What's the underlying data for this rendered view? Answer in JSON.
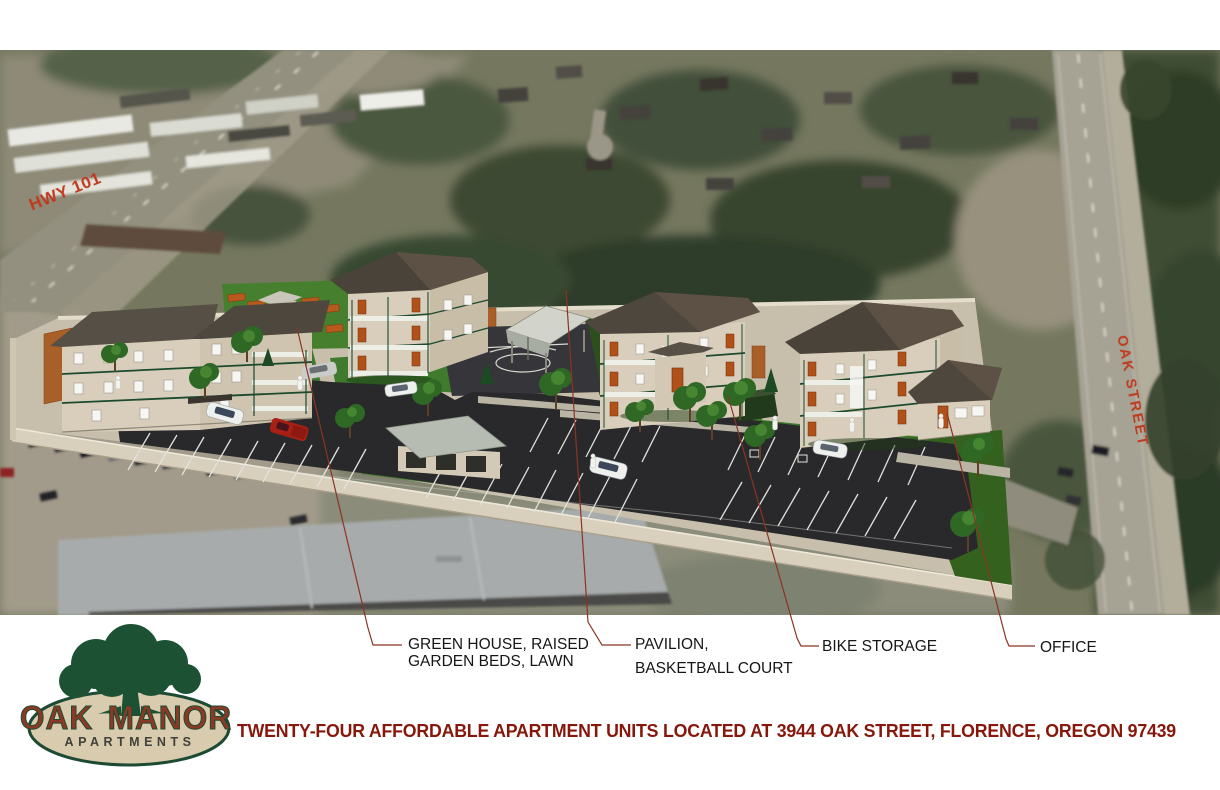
{
  "map_labels": {
    "hwy101": "HWY 101",
    "oak_street": "OAK STREET"
  },
  "callouts": [
    {
      "line1": "GREEN HOUSE, RAISED",
      "line2": "GARDEN BEDS, LAWN",
      "points_to": "greenhouse-and-garden-area"
    },
    {
      "line1": "PAVILION,",
      "line2": "BASKETBALL COURT",
      "points_to": "pavilion"
    },
    {
      "line1": "BIKE STORAGE",
      "points_to": "bike-storage-shed"
    },
    {
      "line1": "OFFICE",
      "points_to": "office-building"
    }
  ],
  "logo": {
    "word1": "OAK",
    "word2": "MANOR",
    "subtitle": "APARTMENTS"
  },
  "tagline": "TWENTY-FOUR AFFORDABLE APARTMENT UNITS LOCATED AT 3944 OAK STREET, FLORENCE, OREGON 97439",
  "colors": {
    "road_label_red": "#bf3a1e",
    "tagline_maroon": "#87170b",
    "leader_line": "#8b3424",
    "logo_green": "#1d4a33",
    "logo_tan": "#d9cbae",
    "logo_maroon": "#8a3a24",
    "lawn_green": "#3f7a2e",
    "asphalt": "#29292c",
    "wall_beige": "#d8d0bd"
  }
}
